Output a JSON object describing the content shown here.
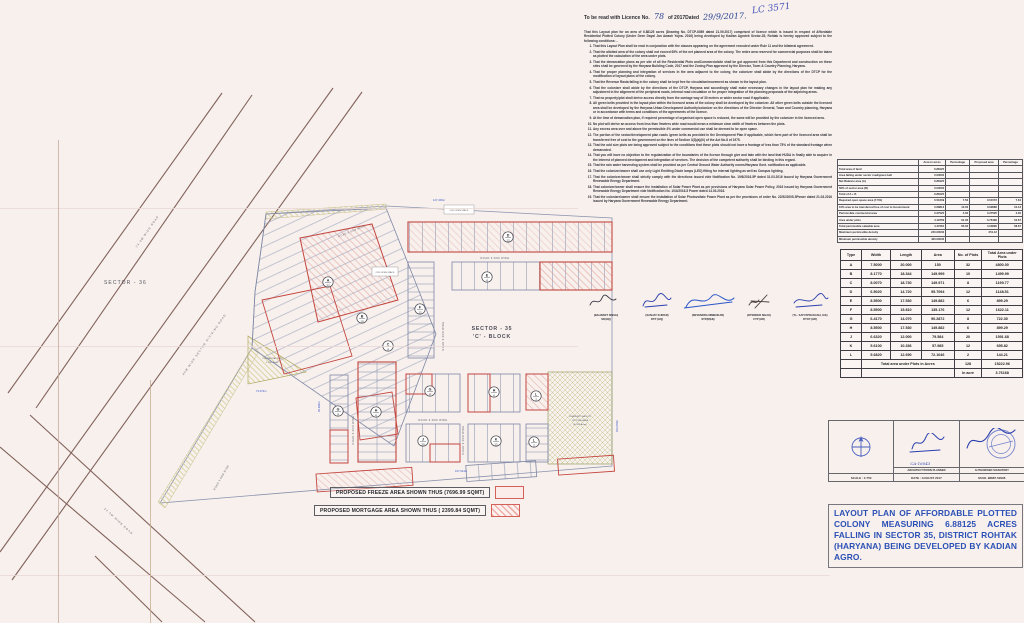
{
  "license_header": {
    "prefix": "To be read with Licence No.",
    "number": "78",
    "middle": "of 2017Dated",
    "date": "29/9/2017.",
    "annotation": "LC 3571"
  },
  "intro": "That this Layout plan for an area of 6.88125 acres (Drawing No. DTCP-6089 dated 21.09.2017) comprised of licence which is issued in respect of Affordable Residential Plotted Colony (Under Deen Dayal Jan Awash Yojna- 2016) being developed by Kadian Agrotek Sector-35, Rohtak is hereby approved subject to the following conditions: -",
  "conditions": [
    "That this Layout Plan shall be read in conjunction with the clauses appearing on the agreement executed under Rule 11 and the bilateral agreement.",
    "That the allotted area of the colony shall not exceed 65% of the net planned area of the colony. The entire area reserved for commercial purposes shall be taken as plotted the calculation of the area under plots.",
    "That the demarcation plans as per site of all the Residential Plots andCommercialsite shall be got approved from this Department and construction on these sites shall be governed by the Haryana Building Code, 2017 and the Zoning Plan approved by the Director, Town & Country Planning, Haryana.",
    "That for proper planning and integration of services in the area adjacent to the colony, the colonizer shall abide by the directions of the DTCP for the modification of layout plans of the colony.",
    "That the Revenue Rasta falling in the colony shall be kept free for circulation/movement as shown in the layout plan.",
    "That the colonizer shall abide by the directions of the DTCP, Haryana and accordingly shall make necessary changes in the layout plan for making any adjustment in the alignment of the peripheral roads, internal road circulation or for proper integration of the planning proposals of the adjoining areas.",
    "That no property/plot shall derive access directly from the carriage way of 30 metres or wider sector road if applicable.",
    "All green belts provided in the layout plan within the licenced areas of the colony shall be developed by the colonizer. All other green belts outside the licenced area shall be developed by the Haryana Urban Development Authority/colonizer on the directions of the Director General, Town and Country planning, Haryana or in accordance with terms and conditions of the agreements of the licence.",
    "At the time of demarcation plan, if required percentage of organised open space is reduced, the same will be provided by the colonizer in the licenced area.",
    "No plot will derive an access from less than 9metres wide road would mean a minimum clear width of 9metres between the plots.",
    "Any excess area over and above the permissible 4% under commercial use shall be deemed to be open space.",
    "The portion of the sector/development plan roads /green belts as provided in the Development Plan if applicable, which form part of the licenced area shall be transferred free of cost to the government on the lines of Section 3(3)(a)(iii) of the Act No.8 of 1975.",
    "That the odd size plots are being approved subject to the conditions that these plots should not have a frontage of less than 75% of the standard frontage when demarcated.",
    "That you will have no objection to the regularization of the boundaries of the licence through give and take with the land that HUDA is finally able to acquire in the interest of planned development and integration of services. The decision of the competent authority shall be binding in this regard.",
    "That the rain water harvesting system shall be provided as per Central Ground Water Authority norms/Haryana Govt. notification as applicable.",
    "That the colonizer/owner shall use only Light Emitting Diode lamps (LED) fitting for internal lighting as well as Campus lighting.",
    "That the colonizer/owner shall strictly comply with the directions issued vide Notification No. 19/6/2016-5P dated 31.03.2016 issued by Haryana Government Renewable Energy Department.",
    "That colonizer/owner shall ensure the installation of Solar Power Plant as per provisions of Haryana Solar Power Policy, 2016 issued by Haryana Government Renewable Energy Department vide Notification No. 10/4/2016-5 Power dated 14.03.2016.",
    "That the colonizer/owner shall ensure the installation of Solar Photovoltaic Power Plant as per the provisions of order No. 22/52/2005-5Power dated 21.03.2016 issued by Haryana Government Renewable Energy Department."
  ],
  "signatures": [
    {
      "name": "(BALWANT SINGH)",
      "title": "SD(HQ)"
    },
    {
      "name": "(SANJAY KUMAR)",
      "title": "DTP (HQ)"
    },
    {
      "name": "(DEVENDRA NIMBOKAR)",
      "title": "STP(M)HQ"
    },
    {
      "name": "(JITENDER SIHAG)",
      "title": "CTP (HR)"
    },
    {
      "name": "(T.L. SATYAPRAKASH, IAS)",
      "title": "DTCP (HR)"
    }
  ],
  "area_table": {
    "headers": [
      "",
      "Area in acres",
      "Percentage",
      "Proposed area",
      "Percentage"
    ],
    "rows": [
      [
        "Total area of land",
        "6.88125",
        "",
        "",
        ""
      ],
      [
        "Area falling under sector road/green belt",
        "0.00000",
        "",
        "",
        ""
      ],
      [
        "Net Balance area (A)",
        "6.88125",
        "",
        "",
        ""
      ],
      [
        "50% of sector area (B)",
        "0.00000",
        "",
        "",
        ""
      ],
      [
        "Total of A + B",
        "6.88125",
        "",
        "",
        ""
      ],
      [
        "Required open space area (7.5%)",
        "0.51609",
        "7.50",
        "0.51572",
        "7.64"
      ],
      [
        "10% area to be transferred free of cost to Government",
        "0.68813",
        "10.00",
        "0.69686",
        "10.13"
      ],
      [
        "Permissible commercial area",
        "0.27525",
        "4.00",
        "0.27525",
        "4.00"
      ],
      [
        "Area under plots",
        "4.19756",
        "61.00",
        "3.76166",
        "54.67"
      ],
      [
        "Total permissible saleable area",
        "4.47281",
        "65.00",
        "4.03690",
        "58.67"
      ],
      [
        "Maximum permissible density",
        "240.00000",
        "",
        "251.12",
        ""
      ],
      [
        "Minimum permissible density",
        "400.00000",
        "",
        "",
        ""
      ]
    ]
  },
  "plots_table": {
    "headers": [
      "Type",
      "Width",
      "Length",
      "Area",
      "No. of Plots",
      "Total Area under Plots"
    ],
    "rows": [
      [
        "A",
        "7.5000",
        "20.000",
        "150",
        "32",
        "4800.00"
      ],
      [
        "B",
        "8.1770",
        "18.344",
        "149.999",
        "10",
        "1499.99"
      ],
      [
        "C",
        "8.0070",
        "18.730",
        "149.971",
        "8",
        "1199.77"
      ],
      [
        "D",
        "6.5020",
        "14.720",
        "95.7094",
        "12",
        "1148.51"
      ],
      [
        "E",
        "8.5500",
        "17.530",
        "149.882",
        "6",
        "899.29"
      ],
      [
        "F",
        "8.5500",
        "15.810",
        "135.176",
        "12",
        "1622.11"
      ],
      [
        "G",
        "6.4170",
        "14.070",
        "90.2872",
        "8",
        "722.30"
      ],
      [
        "H",
        "8.5500",
        "17.530",
        "149.882",
        "6",
        "899.29"
      ],
      [
        "J",
        "6.6320",
        "12.000",
        "79.584",
        "20",
        "1591.68"
      ],
      [
        "K",
        "5.6100",
        "10.336",
        "57.985",
        "12",
        "695.82"
      ],
      [
        "L",
        "5.6820",
        "12.690",
        "72.1046",
        "2",
        "144.21"
      ]
    ],
    "total_label": "Total area under Plots in Acres",
    "total_plots": "128",
    "total_area": "15222.96",
    "in_acre_label": "In acre",
    "in_acre_value": "3.76168"
  },
  "title_block": {
    "scale": "SCALE : 1:750",
    "architect_reg": "CA-16043",
    "architect_caption": "ARCHITECT/TOWN PLANNER",
    "date": "DATE : AUGUST 2017",
    "authorised_caption": "AUTHORISED SIGNATORY",
    "mobile": "M.NO. 98887-52996"
  },
  "project_title": "LAYOUT PLAN OF AFFORDABLE PLOTTED COLONY MEASURING 6.88125 ACRES FALLING IN SECTOR 35, DISTRICT ROHTAK (HARYANA) BEING DEVELOPED BY KADIAN AGRO.",
  "legend": {
    "freeze": "PROPOSED FREEZE AREA SHOWN THUS (7696.99 SQMT)",
    "mortgage": "PROPOSED MORTGAGE  AREA SHOWN THUS ( 2399.84 SQMT)"
  },
  "map": {
    "sector36": "SECTOR - 36",
    "sector35_line1": "SECTOR - 35",
    "sector35_line2": "'C' - BLOCK",
    "commercial_line1": "COMMERCIAL SITE",
    "commercial_line2": "1.1732 Acres",
    "community_line1": "COMMUNITY FACILITY",
    "community_line2": "OF TOTAL AREA",
    "community_line3": "(0.5157 Acres)",
    "open_space": "ORG OPEN SPACE",
    "road_9m": "ROAD 9.00M WIDE",
    "diag_road_1": "24.0M WIDE ROAD",
    "diag_road_2": "45M WIDE SECTOR DIVIDING ROAD",
    "diag_road_3": "24.0M WIDE ROAD",
    "dims": {
      "top": "127.406m",
      "bottom": "167.914m",
      "right": "163.078m",
      "left_v": "45.380m",
      "left_b": "74.072m"
    },
    "markers": [
      {
        "t": "A",
        "n": "32",
        "x": 328,
        "y": 282
      },
      {
        "t": "B",
        "n": "10",
        "x": 362,
        "y": 318
      },
      {
        "t": "C",
        "n": "8",
        "x": 388,
        "y": 346
      },
      {
        "t": "D",
        "n": "12",
        "x": 508,
        "y": 237
      },
      {
        "t": "E",
        "n": "6",
        "x": 487,
        "y": 277
      },
      {
        "t": "F",
        "n": "12",
        "x": 420,
        "y": 309
      },
      {
        "t": "G",
        "n": "8",
        "x": 338,
        "y": 411
      },
      {
        "t": "H",
        "n": "6",
        "x": 376,
        "y": 412
      },
      {
        "t": "G",
        "n": "8",
        "x": 430,
        "y": 391
      },
      {
        "t": "H",
        "n": "6",
        "x": 494,
        "y": 392
      },
      {
        "t": "L",
        "n": "2",
        "x": 536,
        "y": 396
      },
      {
        "t": "J",
        "n": "20",
        "x": 423,
        "y": 441
      },
      {
        "t": "K",
        "n": "12",
        "x": 496,
        "y": 441
      },
      {
        "t": "L",
        "n": "2",
        "x": 534,
        "y": 442
      }
    ]
  }
}
